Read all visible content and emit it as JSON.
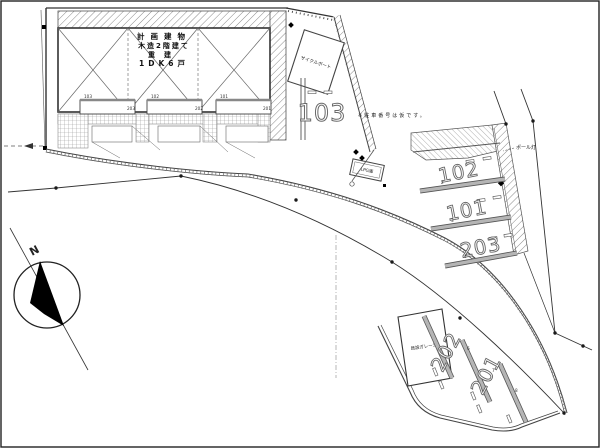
{
  "building": {
    "line1": "計画建物",
    "line2": "木造2階建て",
    "line3": "重建",
    "line4": "1DK6戸",
    "units_top": [
      "103",
      "102",
      "101"
    ],
    "units_sub": [
      "203",
      "202",
      "201"
    ]
  },
  "labels": {
    "cycle_port": "サイクルポート",
    "note": "※駐車番号は仮です。",
    "pole_light": "ポール灯",
    "lpg": "LPG庫",
    "garage": "既設ガレージ",
    "north": "N"
  },
  "stalls": {
    "upper": "103",
    "right": [
      "102",
      "101",
      "203"
    ],
    "bottom": [
      "202",
      "201"
    ],
    "point_numbers": [
      "2",
      "3",
      "4",
      "6",
      "7",
      "8"
    ]
  },
  "colors": {
    "line": "#333333",
    "hatch": "#8a8a8a",
    "bar": "#a8a8a8",
    "background": "#ffffff"
  }
}
